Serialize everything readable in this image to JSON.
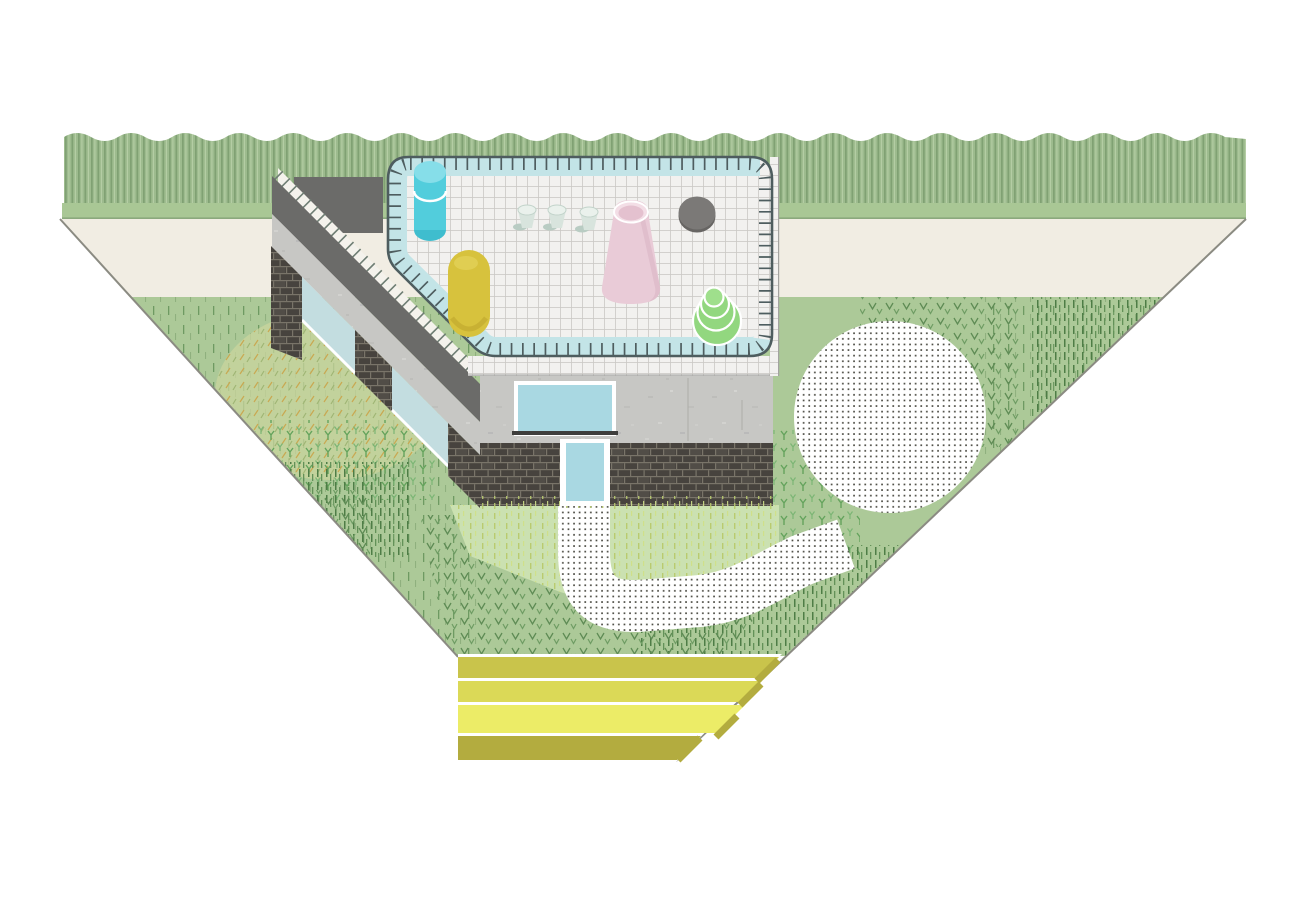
{
  "meta": {
    "kind": "architectural-axonometric-illustration",
    "subject": "house with rooftop tiled terrace, hedge, triangular garden, gravel circle, winding path and yellow garden steps",
    "text_content": "none"
  },
  "palette": {
    "page_bg": "#ffffff",
    "hedge_green": "#9dbb8e",
    "lawn_strip": "#a9c795",
    "strip_line": "#84a077",
    "cream_band": "#f1ede3",
    "garden_green": "#acc998",
    "light_patch": "#cbe1b1",
    "yellow_patch": "#c9d49e",
    "edge_line": "#8b8b82",
    "tile_white": "#f2f1ef",
    "tile_line": "#cbc9c5",
    "railing": "#4e5d5f",
    "pool_band": "#c3e4e7",
    "concrete": "#c7c7c4",
    "parapet_dark": "#6b6b69",
    "brick_dark": "#47433e",
    "window_blue": "#a9d8e2",
    "wing_window_blue": "#c3dde0",
    "door_blue": "#a9d8e2",
    "sill_dark": "#3e3e3c",
    "cylinder_cyan": "#52cddc",
    "cylinder_cyan_top": "#86dee9",
    "cylinder_cyan_dark": "#3fbdce",
    "capsule_yellow": "#d7c23d",
    "cone_pink": "#e9cbd7",
    "cone_pink_rim": "#f3dee6",
    "disc_gray": "#7b7977",
    "disc_gray_dark": "#676563",
    "mound_green": "#92d77f",
    "mound_green_top": "#9fdf8c",
    "cup_mint": "#d8e4dd",
    "cup_mint_top": "#eaf1ec",
    "dot_ink": "#4c4c44",
    "step_1": "#c9c44b",
    "step_2": "#dbd957",
    "step_3": "#ecec67",
    "step_front": "#b3ac3f",
    "white": "#ffffff"
  },
  "scene": {
    "background_bands": [
      {
        "name": "hedge",
        "style": "vertical-striped hedge with wavy top"
      },
      {
        "name": "lawn-strip",
        "style": "flat green strip"
      },
      {
        "name": "perimeter-path",
        "style": "cream band between diagonals"
      }
    ],
    "garden": {
      "shape": "triangle tapering downward",
      "textures": [
        "sparse grass dashes",
        "dense grass dashes",
        "v-shaped marks",
        "y-shaped tufts",
        "yellowish patch",
        "light green patch"
      ],
      "features": [
        {
          "name": "gravel-circle",
          "style": "white circle with dot grid"
        },
        {
          "name": "winding-path",
          "style": "white dotted path from door to gravel circle"
        },
        {
          "name": "garden-steps",
          "style": "three yellow terraced steps with olive front face"
        }
      ]
    },
    "building": {
      "wing": "diagonal wing with dark parapet, concrete band, blue windows and brick piers",
      "front": "concrete band with window above dark brick base with blue door",
      "terrace": "rounded tiled roof terrace with railing posts and inner light-blue band"
    },
    "terrace_objects": [
      {
        "name": "cyan-cylinder"
      },
      {
        "name": "yellow-capsule"
      },
      {
        "name": "mint-cup",
        "count": 3
      },
      {
        "name": "pink-cone"
      },
      {
        "name": "gray-disc"
      },
      {
        "name": "green-stacked-mound"
      }
    ]
  }
}
